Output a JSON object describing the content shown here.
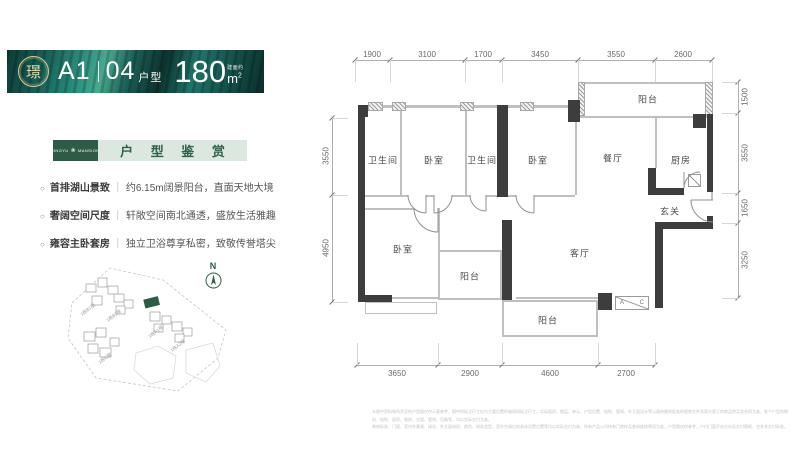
{
  "banner": {
    "seal_char": "璟",
    "unit": "A1",
    "type_num": "04",
    "type_label": "户型",
    "area": "180",
    "area_prefix": "建面约",
    "area_unit_m": "m",
    "area_sup": "2"
  },
  "section": {
    "badge_left": "JINGYU",
    "badge_emblem": "❀",
    "badge_right": "MANSION",
    "title": "户 型 鉴 赏"
  },
  "features": [
    {
      "marker": "○",
      "title": "首排湖山景致",
      "sep": "｜",
      "desc": "约6.15m阔景阳台，直面天地大境"
    },
    {
      "marker": "○",
      "title": "奢阔空间尺度",
      "sep": "｜",
      "desc": "轩敞空间南北通透，盛放生活雅趣"
    },
    {
      "marker": "○",
      "title": "雍容主卧套房",
      "sep": "｜",
      "desc": "独立卫浴尊享私密，致敬传誉塔尖"
    }
  ],
  "siteplan": {
    "compass_label": "N",
    "buildings": [
      "1栋B1座",
      "1栋B2座",
      "1栋C座",
      "1栋A1座",
      "1栋A2座"
    ]
  },
  "floorplan": {
    "rooms": {
      "bath1": "卫生间",
      "bed1": "卧室",
      "bath2": "卫生间",
      "bed2": "卧室",
      "dining": "餐厅",
      "kitchen": "厨房",
      "foyer": "玄关",
      "living": "客厅",
      "bed3": "卧室",
      "balcony_top": "阳台",
      "balcony_small": "阳台",
      "balcony_bottom": "阳台",
      "ac_a": "A",
      "ac_c": "C"
    },
    "dims": {
      "top": [
        "1900",
        "3100",
        "1700",
        "3450",
        "3550",
        "2600"
      ],
      "bottom": [
        "3650",
        "2900",
        "4600",
        "2700"
      ],
      "left": [
        "3550",
        "4950"
      ],
      "right": [
        "1500",
        "3550",
        "1650",
        "3250"
      ]
    }
  },
  "disclaimer": {
    "line1": "本图中资料和所涉及的户型图仅供示意参考，图中所标注尺寸仅为主要位置的轴线间标注尺寸，实际面积、楼层、单元、户型位置、结构、管线、外立面设计等以政府最终批准的规划文件及双方签订的商品房买卖合同为准，各个户型的朝向、结构、面积、装修、交楼、管线、设备等，均以实际交付为准。",
    "line2": "装修标准、门窗、室内外景观、绿化、外立面材质、颜色、线条造型、室外空调位的具体设置位置等均以实际交付为准，所有产品公司持有门禁样品查阅维修预设为准，户型图仅供参考，户内门窗开启方向及交付图纸，也并非交付标准。"
  },
  "colors": {
    "accent_green": "#2d5b45",
    "banner_teal": "#1b6a5c",
    "header_bg": "#dce8df",
    "wall_dark": "#3d3d3d"
  }
}
